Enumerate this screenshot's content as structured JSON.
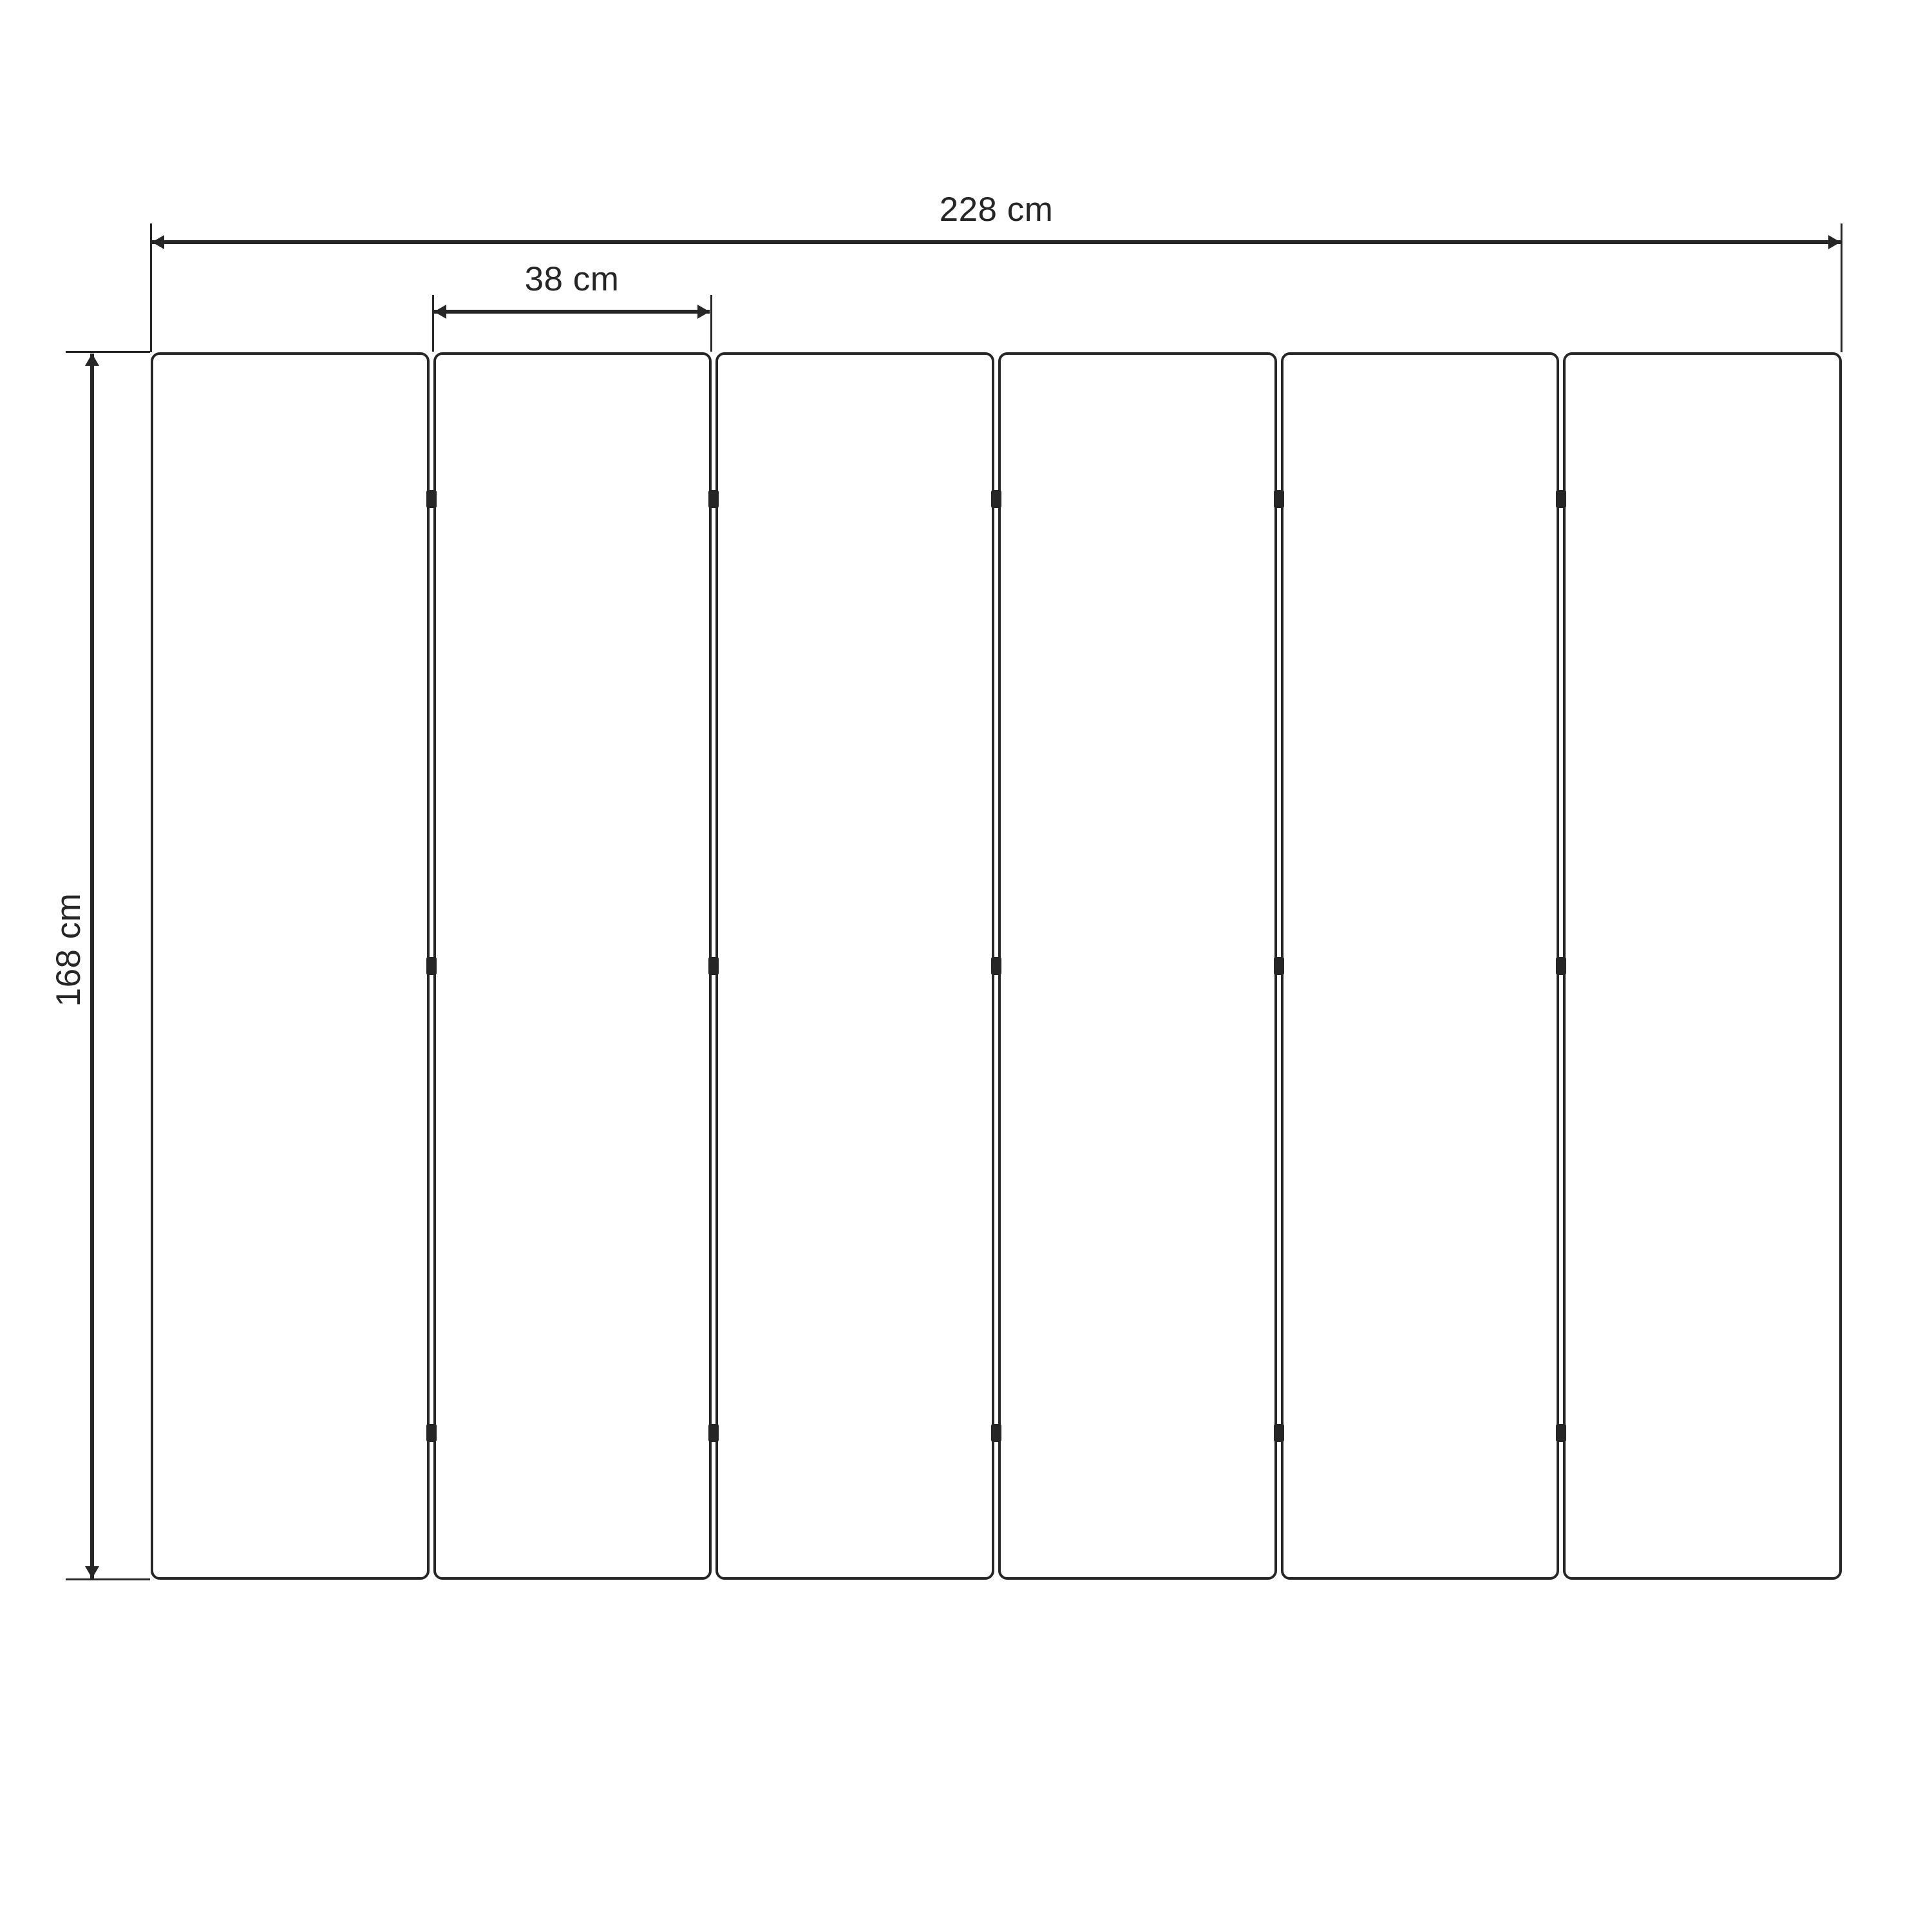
{
  "diagram": {
    "type": "technical-dimension-drawing",
    "ink_color": "#262626",
    "background_color": "#ffffff",
    "panels": {
      "count": 6,
      "gaps": 5,
      "hinge_marks_per_gap": 3
    },
    "dims": {
      "total_width_label": "228 cm",
      "panel_width_label": "38 cm",
      "height_label": "168 cm"
    }
  }
}
